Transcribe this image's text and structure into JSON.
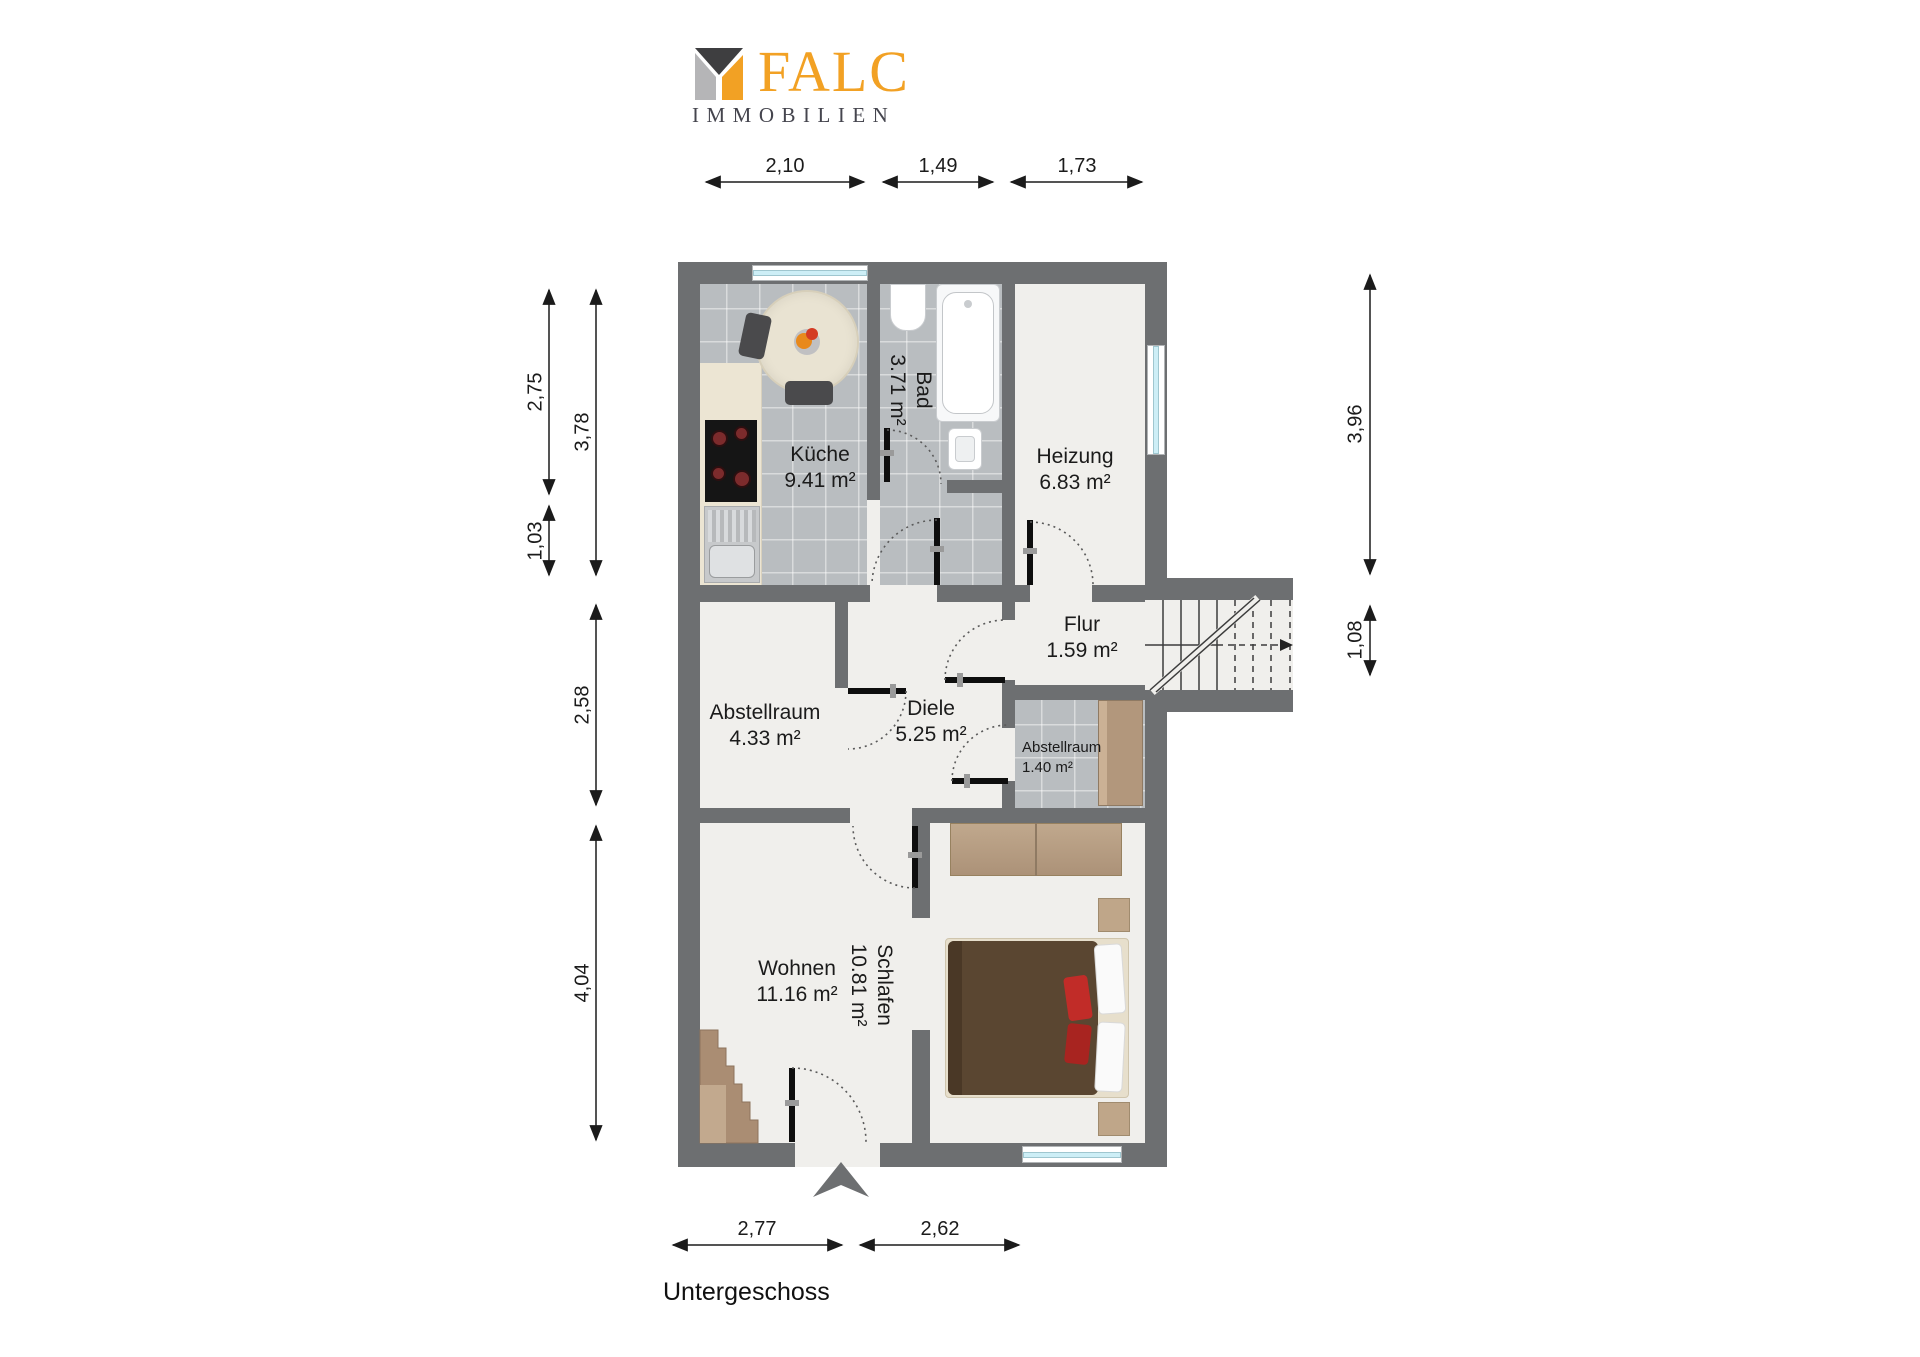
{
  "logo": {
    "brand": "FALC",
    "subtitle": "IMMOBILIEN",
    "colors": {
      "orange": "#f2a124",
      "dark": "#3e3e40",
      "light_gray": "#b5b5b7",
      "subtitle_gray": "#45454e"
    }
  },
  "floor_title": "Untergeschoss",
  "rooms": {
    "kueche": {
      "name": "Küche",
      "area": "9.41 m²"
    },
    "bad": {
      "name": "Bad",
      "area": "3.71 m²"
    },
    "heizung": {
      "name": "Heizung",
      "area": "6.83 m²"
    },
    "flur": {
      "name": "Flur",
      "area": "1.59 m²"
    },
    "abstellraum_gross": {
      "name": "Abstellraum",
      "area": "4.33 m²"
    },
    "diele": {
      "name": "Diele",
      "area": "5.25 m²"
    },
    "abstellraum_klein": {
      "name": "Abstellraum",
      "area": "1.40 m²"
    },
    "wohnen": {
      "name": "Wohnen",
      "area": "11.16 m²"
    },
    "schlafen": {
      "name": "Schlafen",
      "area": "10.81 m²"
    }
  },
  "dimensions": {
    "top": [
      "2,10",
      "1,49",
      "1,73"
    ],
    "left_inner": [
      "2,75",
      "1,03"
    ],
    "left_outer": [
      "3,78",
      "2,58",
      "4,04"
    ],
    "right": [
      "3,96",
      "1,08"
    ],
    "bottom": [
      "2,77",
      "2,62"
    ]
  },
  "plan_colors": {
    "wall": "#6d6f71",
    "floor": "#f0efec",
    "tile": "#b9bdc0",
    "window": "#cdeef6"
  }
}
